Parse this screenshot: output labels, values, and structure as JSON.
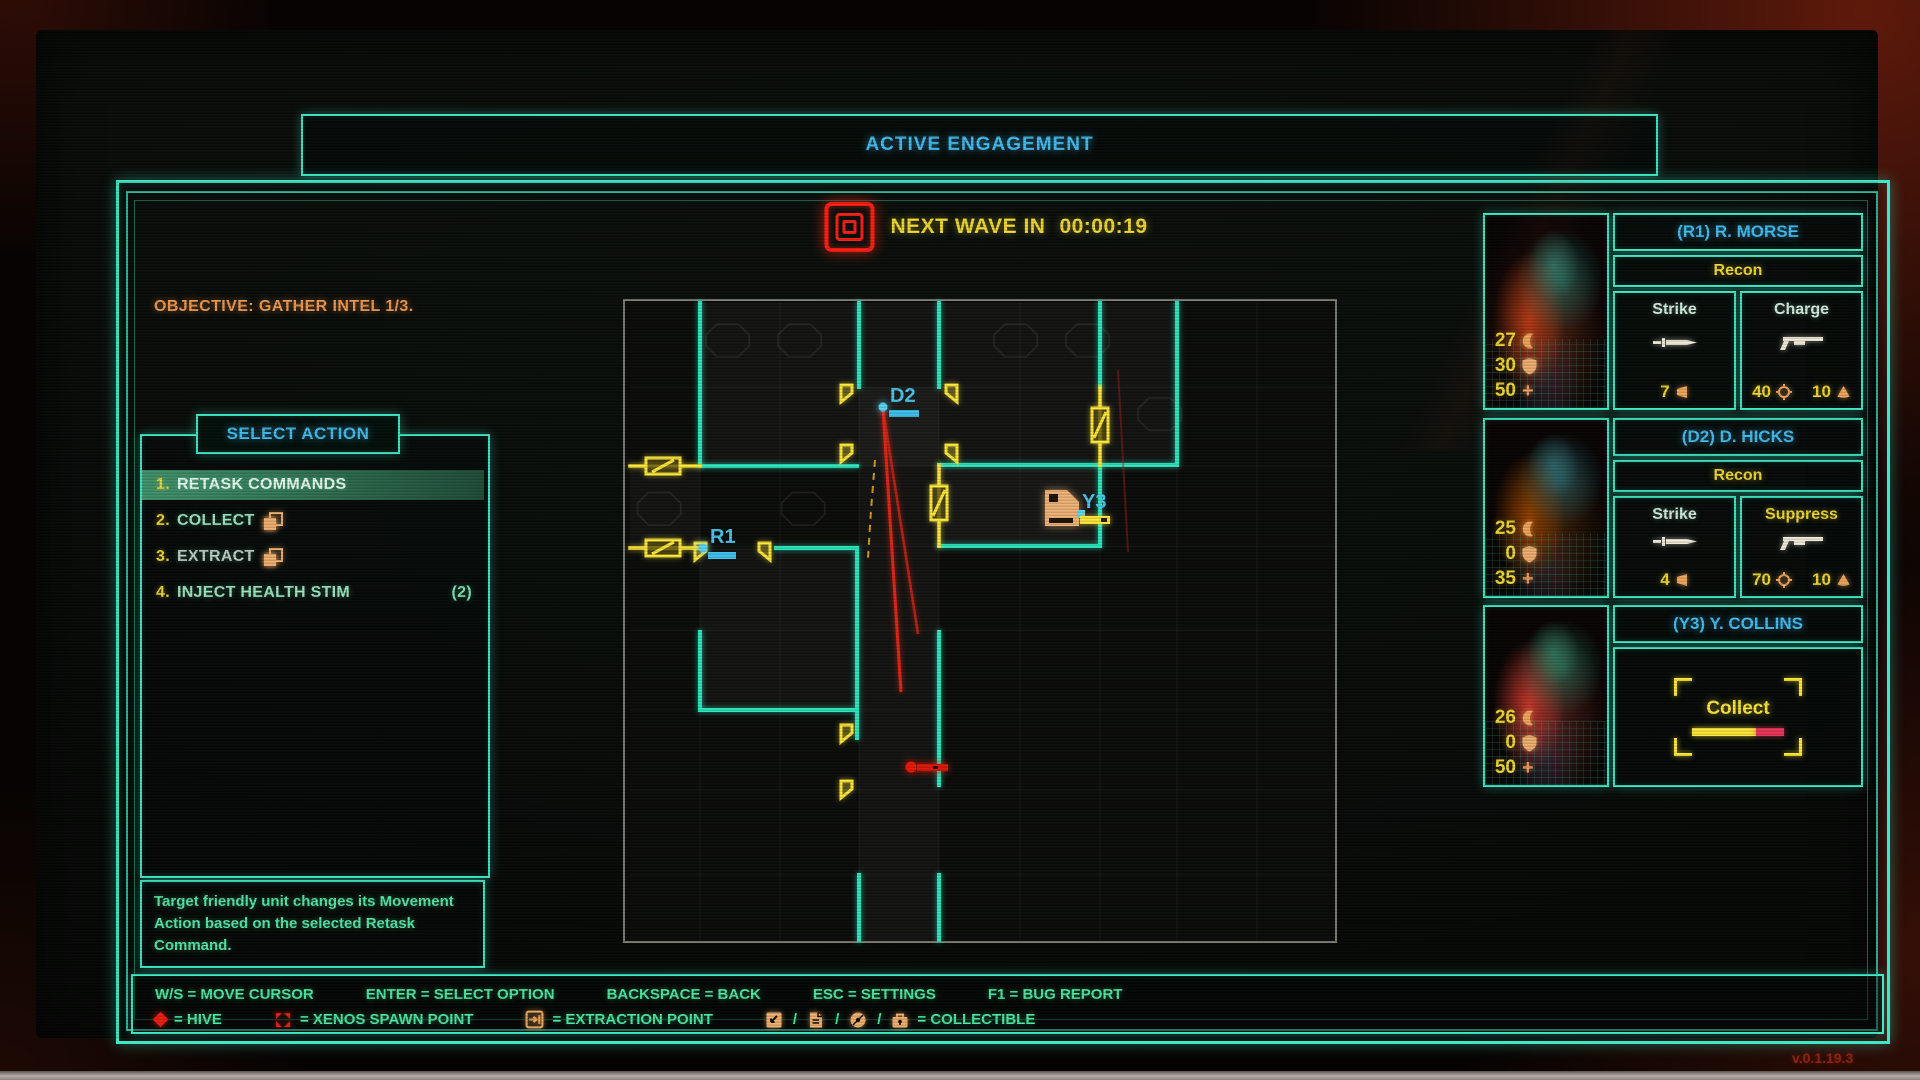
{
  "header": {
    "title": "ACTIVE ENGAGEMENT"
  },
  "wave": {
    "label": "NEXT WAVE IN",
    "timer": "00:00:19"
  },
  "objective": "OBJECTIVE: GATHER INTEL 1/3.",
  "action_panel": {
    "title": "SELECT ACTION",
    "items": [
      {
        "num": "1.",
        "label": "RETASK COMMANDS"
      },
      {
        "num": "2.",
        "label": "COLLECT"
      },
      {
        "num": "3.",
        "label": "EXTRACT"
      },
      {
        "num": "4.",
        "label": "INJECT HEALTH STIM",
        "count": "(2)"
      }
    ],
    "description": "Target friendly unit changes its Movement Action based on the selected Retask Command."
  },
  "map": {
    "units": {
      "d2": "D2",
      "r1": "R1",
      "y3": "Y3"
    }
  },
  "squad": [
    {
      "name": "(R1) R. MORSE",
      "class": "Recon",
      "stats": {
        "attack": "27",
        "shield": "30",
        "health": "50"
      },
      "abilities": [
        {
          "name": "Strike",
          "stat1": "7"
        },
        {
          "name": "Charge",
          "stat1": "40",
          "stat2": "10"
        }
      ]
    },
    {
      "name": "(D2) D. HICKS",
      "class": "Recon",
      "stats": {
        "attack": "25",
        "shield": "0",
        "health": "35"
      },
      "abilities": [
        {
          "name": "Strike",
          "stat1": "4"
        },
        {
          "name": "Suppress",
          "stat1": "70",
          "stat2": "10"
        }
      ]
    },
    {
      "name": "(Y3) Y. COLLINS",
      "stats": {
        "attack": "26",
        "shield": "0",
        "health": "50"
      },
      "action": {
        "label": "Collect"
      }
    }
  ],
  "hints": {
    "keys": [
      "W/S = MOVE CURSOR",
      "ENTER = SELECT OPTION",
      "BACKSPACE = BACK",
      "ESC = SETTINGS",
      "F1 = BUG REPORT"
    ],
    "legend": {
      "hive": "= HIVE",
      "xenos": "= XENOS SPAWN POINT",
      "extraction": "= EXTRACTION POINT",
      "collectible": "= COLLECTIBLE"
    }
  },
  "version": "v.0.1.19.3",
  "icons": {
    "wave": "hive-concentric-red-squares",
    "hive": "red-diamond",
    "xenos_spawn": "red-quad-triangles",
    "extraction": "arrow-into-wall-square",
    "collectible_terminal": "square-with-corner-arrow",
    "collectible_document": "page-with-fold",
    "collectible_disc": "disc-with-slash",
    "collectible_case": "locked-case",
    "stat_attack": "claw-crescent",
    "stat_shield": "shield",
    "stat_health": "plus",
    "ability_strike": "knife",
    "ability_ranged": "shotgun",
    "ammo": "horn",
    "accuracy": "crosshair-circle",
    "blast": "cone"
  },
  "colors": {
    "teal": "#3fe8c6",
    "cyan": "#46bdf0",
    "yellow": "#f2d937",
    "orange": "#f0a55c",
    "green": "#52e2a2",
    "red": "#e42218",
    "highlight_green": "#48a478"
  }
}
